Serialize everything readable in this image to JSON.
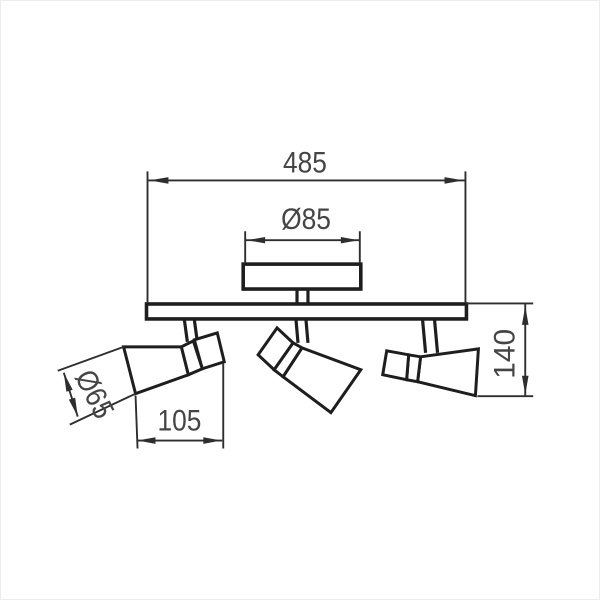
{
  "page": {
    "background": "#ffffff",
    "border": "#ededed"
  },
  "drawing": {
    "colors": {
      "object_line": "#1e1e1e",
      "dimension_line": "#2e2e2e",
      "label_text": "#454545"
    },
    "labels": {
      "overall_width": "485",
      "canopy_diameter": "Ø85",
      "head_diameter": "Ø65",
      "head_length": "105",
      "fixture_height": "140"
    }
  }
}
